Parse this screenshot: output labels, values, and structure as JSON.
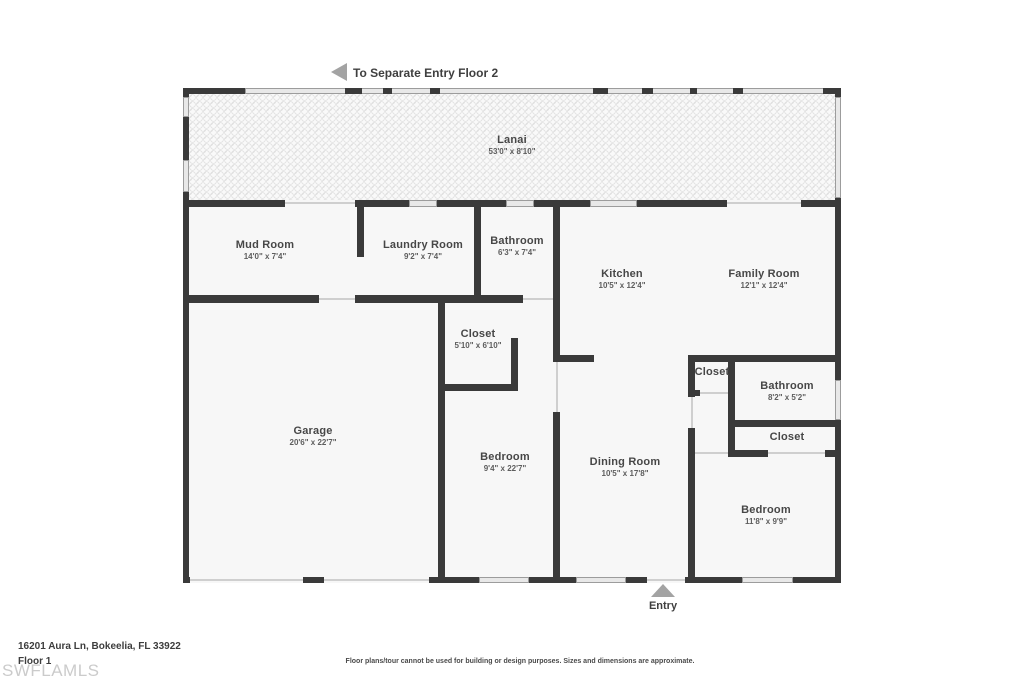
{
  "annotations": {
    "separate_entry_label": "To Separate Entry Floor 2",
    "entry_label": "Entry"
  },
  "rooms": [
    {
      "id": "lanai",
      "name": "Lanai",
      "dims": "53'0\" x 8'10\""
    },
    {
      "id": "mud-room",
      "name": "Mud Room",
      "dims": "14'0\" x 7'4\""
    },
    {
      "id": "laundry-room",
      "name": "Laundry Room",
      "dims": "9'2\" x 7'4\""
    },
    {
      "id": "bathroom-1",
      "name": "Bathroom",
      "dims": "6'3\" x 7'4\""
    },
    {
      "id": "kitchen",
      "name": "Kitchen",
      "dims": "10'5\" x 12'4\""
    },
    {
      "id": "family-room",
      "name": "Family Room",
      "dims": "12'1\" x 12'4\""
    },
    {
      "id": "closet-1",
      "name": "Closet",
      "dims": "5'10\" x 6'10\""
    },
    {
      "id": "garage",
      "name": "Garage",
      "dims": "20'6\" x 22'7\""
    },
    {
      "id": "bedroom-1",
      "name": "Bedroom",
      "dims": "9'4\" x 22'7\""
    },
    {
      "id": "dining-room",
      "name": "Dining Room",
      "dims": "10'5\" x 17'8\""
    },
    {
      "id": "closet-2",
      "name": "Closet"
    },
    {
      "id": "bathroom-2",
      "name": "Bathroom",
      "dims": "8'2\" x 5'2\""
    },
    {
      "id": "closet-3",
      "name": "Closet"
    },
    {
      "id": "bedroom-2",
      "name": "Bedroom",
      "dims": "11'8\" x 9'9\""
    }
  ],
  "footer": {
    "address": "16201 Aura Ln, Bokeelia, FL 33922",
    "floor_label": "Floor 1",
    "watermark": "SWFLAMLS",
    "disclaimer": "Floor plans/tour cannot be used for building or design purposes. Sizes and dimensions are approximate."
  },
  "colors": {
    "wall": "#3a3a3a",
    "room_fill": "#f7f7f7",
    "window_fill": "#e8e8e8",
    "arrow": "#a3a3a3",
    "watermark": "#cbcbcb"
  }
}
